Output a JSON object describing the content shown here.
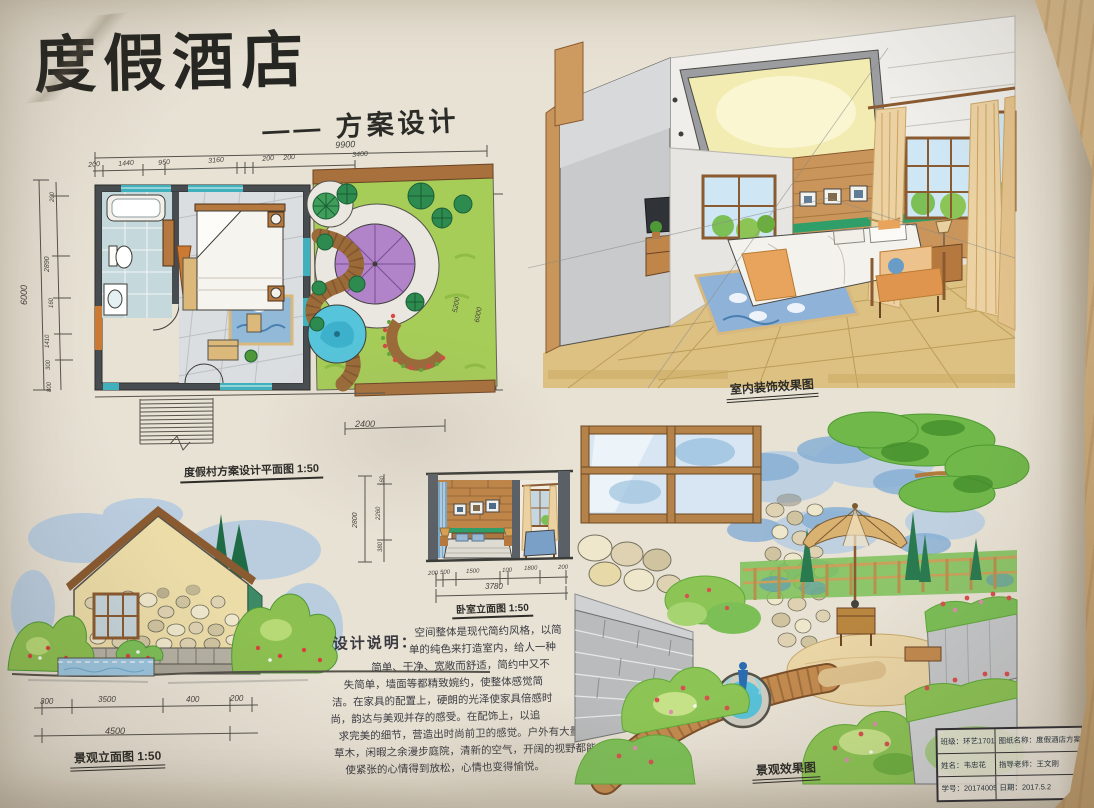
{
  "header": {
    "title": "度假酒店",
    "subtitle": "—— 方案设计"
  },
  "floor_plan": {
    "caption": "度假村方案设计平面图 1:50",
    "total_width": "9900",
    "top_dims": [
      "200",
      "1440",
      "950",
      "3160",
      "200",
      "200",
      "3400"
    ],
    "total_height": "6000",
    "left_dims": [
      "200",
      "2890",
      "160",
      "1410",
      "300",
      "800"
    ],
    "garden_dims": [
      "5200",
      "6000"
    ],
    "stair_dim": "2400"
  },
  "interior_view": {
    "caption": "室内装饰效果图"
  },
  "landscape_elevation": {
    "caption": "景观立面图 1:50",
    "dims": [
      "300",
      "3500",
      "400",
      "200"
    ],
    "total": "4500"
  },
  "bedroom_elevation": {
    "caption": "卧室立面图 1:50",
    "height_total": "2800",
    "height_dims": [
      "160",
      "2260",
      "380"
    ],
    "width_dims": [
      "200",
      "500",
      "1500",
      "100",
      "1800",
      "200"
    ],
    "width_total": "3780"
  },
  "design_notes": {
    "heading": "设计说明：",
    "lines": [
      "空间整体是现代简约风格，以简",
      "单的纯色来打造室内，给人一种",
      "简单、干净、宽敞而舒适，简约中又不",
      "失简单，墙面等都精致婉约，使整体感觉简",
      "洁。在家具的配置上，硬朗的光泽使家具倍感时",
      "尚，韵达与美观并存的感受。在配饰上，以追",
      "求完美的细节，营造出时尚前卫的感觉。户外有大量",
      "草木，闲暇之余漫步庭院，清新的空气，开阔的视野都能",
      "使紧张的心情得到放松，心情也变得愉悦。"
    ]
  },
  "landscape_view": {
    "caption": "景观效果图"
  },
  "title_block": {
    "class_label": "班级：环艺1701",
    "drawing_label": "图纸名称：度假酒店方案设计",
    "name_label": "姓名：韦忠花",
    "advisor_label": "指导老师：王文刚",
    "student_id_label": "学号：20174005",
    "date_label": "日期：2017.5.2"
  },
  "colors": {
    "paper": "#e8e2d5",
    "wood_desk": "#d3b484",
    "ink": "#2c2b28",
    "wall_dark": "#474c50",
    "window_teal": "#3fb0bc",
    "lawn_green": "#a6cd58",
    "umbrella_purple": "#b183c8",
    "pool_blue": "#56c4da",
    "path_brown": "#9a6a38",
    "floor_tan": "#dcc183",
    "curtain_beige": "#ecd2a2",
    "sky_blue": "#a9c6e4",
    "marker_green": "#8cc455",
    "accent_orange": "#e0954e"
  }
}
